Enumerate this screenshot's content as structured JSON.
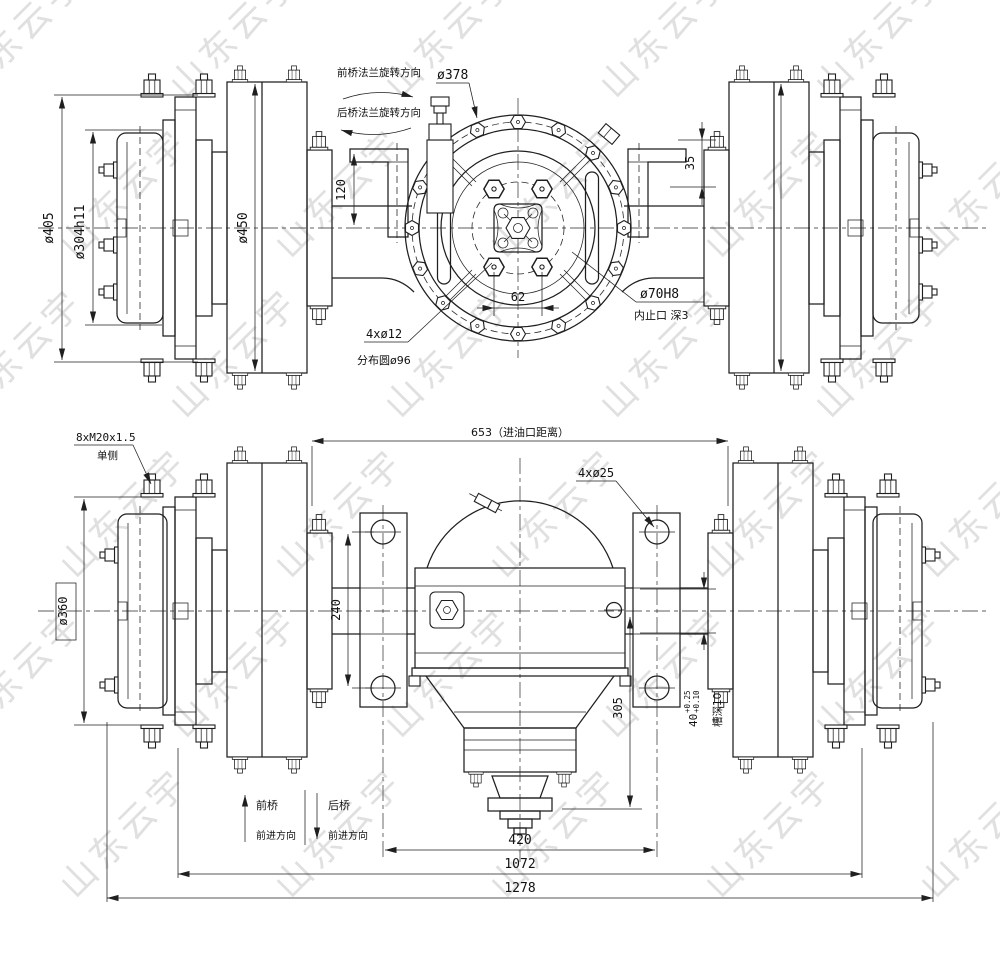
{
  "watermark": {
    "text": "山东云宇"
  },
  "top_view": {
    "rotation_front_label": "前桥法兰旋转方向",
    "rotation_rear_label": "后桥法兰旋转方向",
    "flange_bolt_circle_dia": "ø378",
    "bracket_height_dim": "120",
    "step_dim": "35",
    "housing_dia": "ø450",
    "drum_dia": "ø405",
    "hub_dia": "ø304h11",
    "bolt_spacing_dim": "62",
    "flange_holes_label": "4xø12",
    "flange_holes_circle_label": "分布圆ø96",
    "spigot_dia": "ø70H8",
    "spigot_note": "内止口  深3"
  },
  "bottom_view": {
    "wheel_studs_label": "8xM20x1.5",
    "wheel_studs_note": "单侧",
    "oil_inlet_dim": "653（进油口距离）",
    "bracket_holes_label": "4xø25",
    "brake_drum_dia": "ø360",
    "bracket_hole_spacing_dim": "240",
    "carrier_depth_dim": "305",
    "groove_width_dim": "40",
    "groove_tol_upper": "+0.25",
    "groove_tol_lower": "+0.10",
    "groove_depth_note": "槽深10",
    "bracket_span_dim": "420",
    "mounting_span_dim": "1072",
    "overall_width_dim": "1278",
    "front_axle_label": "前桥",
    "front_axle_dir": "前进方向",
    "rear_axle_label": "后桥",
    "rear_axle_dir": "前进方向"
  }
}
